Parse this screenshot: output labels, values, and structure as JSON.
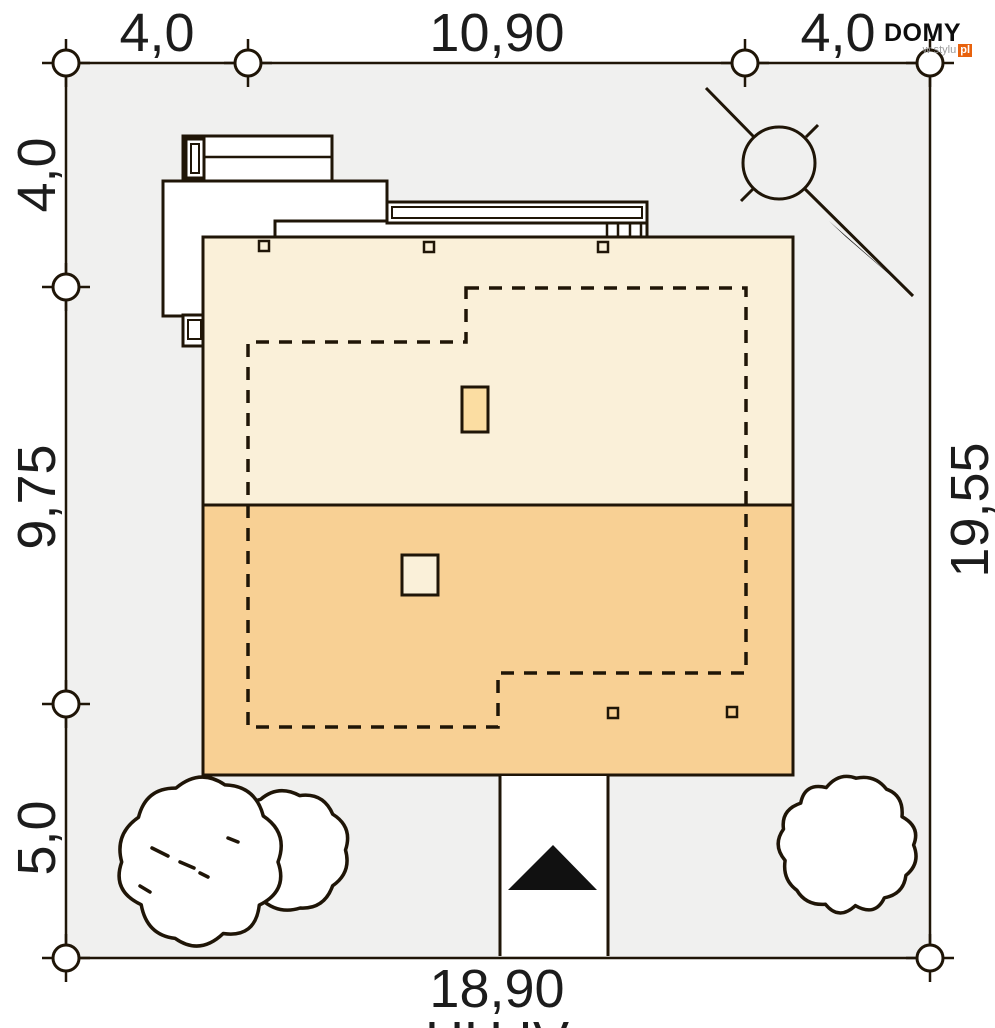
{
  "logo": {
    "domy": "DOMY",
    "wstylu": "w stylu",
    "pl": "pl",
    "pl_bg": "#e8620d"
  },
  "dims": {
    "top_left": "4,0",
    "top_center": "10,90",
    "top_right": "4,0",
    "left_top": "4,0",
    "left_middle": "9,75",
    "left_bottom": "5,0",
    "right_side": "19,55",
    "bottom": "18,90",
    "bottom_partial": "HH IV"
  },
  "colors": {
    "line": "#1f1507",
    "lot_fill": "#f0f0ef",
    "roof_upper": "#faf0d9",
    "roof_lower": "#f8d094",
    "chimney_upper": "#fbdda2",
    "chimney_lower": "#faf0d9",
    "black": "#111111",
    "white": "#ffffff"
  },
  "lot": {
    "x": 66,
    "y": 63,
    "w": 864,
    "h": 895
  },
  "markers": {
    "r": 13,
    "tick": 24,
    "points": [
      [
        66,
        63
      ],
      [
        248,
        63
      ],
      [
        745,
        63
      ],
      [
        930,
        63
      ],
      [
        66,
        287
      ],
      [
        66,
        704
      ],
      [
        66,
        958
      ],
      [
        930,
        958
      ]
    ]
  },
  "roof": {
    "x": 203,
    "y": 237,
    "w": 590,
    "h": 538,
    "divide_y": 505
  },
  "footprint_path": "M466,288 H746 V673 H498 V727 H248 V342 H466 Z",
  "chimneys": [
    {
      "x": 462,
      "y": 387,
      "w": 26,
      "h": 45,
      "fill_key": "chimney_upper"
    },
    {
      "x": 402,
      "y": 555,
      "w": 36,
      "h": 40,
      "fill_key": "chimney_lower"
    }
  ],
  "roof_squares": {
    "size": 10,
    "points": [
      [
        259,
        241
      ],
      [
        424,
        242
      ],
      [
        598,
        242
      ],
      [
        608,
        708
      ],
      [
        727,
        707
      ]
    ]
  },
  "structures": {
    "rects": [
      {
        "x": 163,
        "y": 181,
        "w": 224,
        "h": 135,
        "sw": 3
      },
      {
        "x": 275,
        "y": 221,
        "w": 372,
        "h": 16,
        "sw": 3
      },
      {
        "x": 387,
        "y": 202,
        "w": 260,
        "h": 21,
        "sw": 3
      },
      {
        "x": 392,
        "y": 207,
        "w": 250,
        "h": 11,
        "sw": 2
      },
      {
        "x": 183,
        "y": 136,
        "w": 149,
        "h": 45,
        "sw": 3
      },
      {
        "x": 186,
        "y": 139,
        "w": 18,
        "h": 39,
        "sw": 3
      },
      {
        "x": 191,
        "y": 144,
        "w": 8,
        "h": 29,
        "sw": 2
      },
      {
        "x": 183,
        "y": 315,
        "w": 24,
        "h": 31,
        "sw": 3
      },
      {
        "x": 188,
        "y": 320,
        "w": 13,
        "h": 19,
        "sw": 2
      }
    ],
    "lines": [
      [
        204,
        157,
        332,
        157
      ]
    ],
    "hatches": [
      [
        607,
        223,
        607,
        236
      ],
      [
        618,
        223,
        618,
        236
      ],
      [
        630,
        223,
        630,
        236
      ],
      [
        641,
        223,
        641,
        236
      ]
    ]
  },
  "driveway": {
    "x": 500,
    "y": 776,
    "w": 108,
    "h": 180
  },
  "arrow_points": "553,845 597,890 508,890",
  "trees": {
    "left_marks": [
      [
        152,
        848,
        168,
        856
      ],
      [
        180,
        862,
        194,
        868
      ],
      [
        200,
        873,
        208,
        877
      ],
      [
        140,
        886,
        150,
        892
      ],
      [
        228,
        838,
        238,
        842
      ]
    ],
    "blobs": [
      {
        "cx": 290,
        "cy": 850,
        "r": 58,
        "n": 9,
        "depth": 0.13,
        "seed": 7,
        "kind": "deciduous"
      },
      {
        "cx": 200,
        "cy": 862,
        "r": 78,
        "n": 10,
        "depth": 0.14,
        "seed": 3,
        "kind": "deciduous"
      },
      {
        "cx": 848,
        "cy": 845,
        "r": 66,
        "n": 13,
        "depth": 0.1,
        "seed": 11,
        "kind": "conifer"
      }
    ]
  },
  "compass": {
    "cx": 779,
    "cy": 163,
    "r": 36,
    "lines": [
      [
        706,
        88,
        753.5,
        136.5
      ],
      [
        804.5,
        188.5,
        913,
        296
      ],
      [
        806,
        137,
        818,
        125
      ],
      [
        741,
        201,
        753,
        189
      ]
    ],
    "arrow": "829,221 846,237 912,294"
  }
}
